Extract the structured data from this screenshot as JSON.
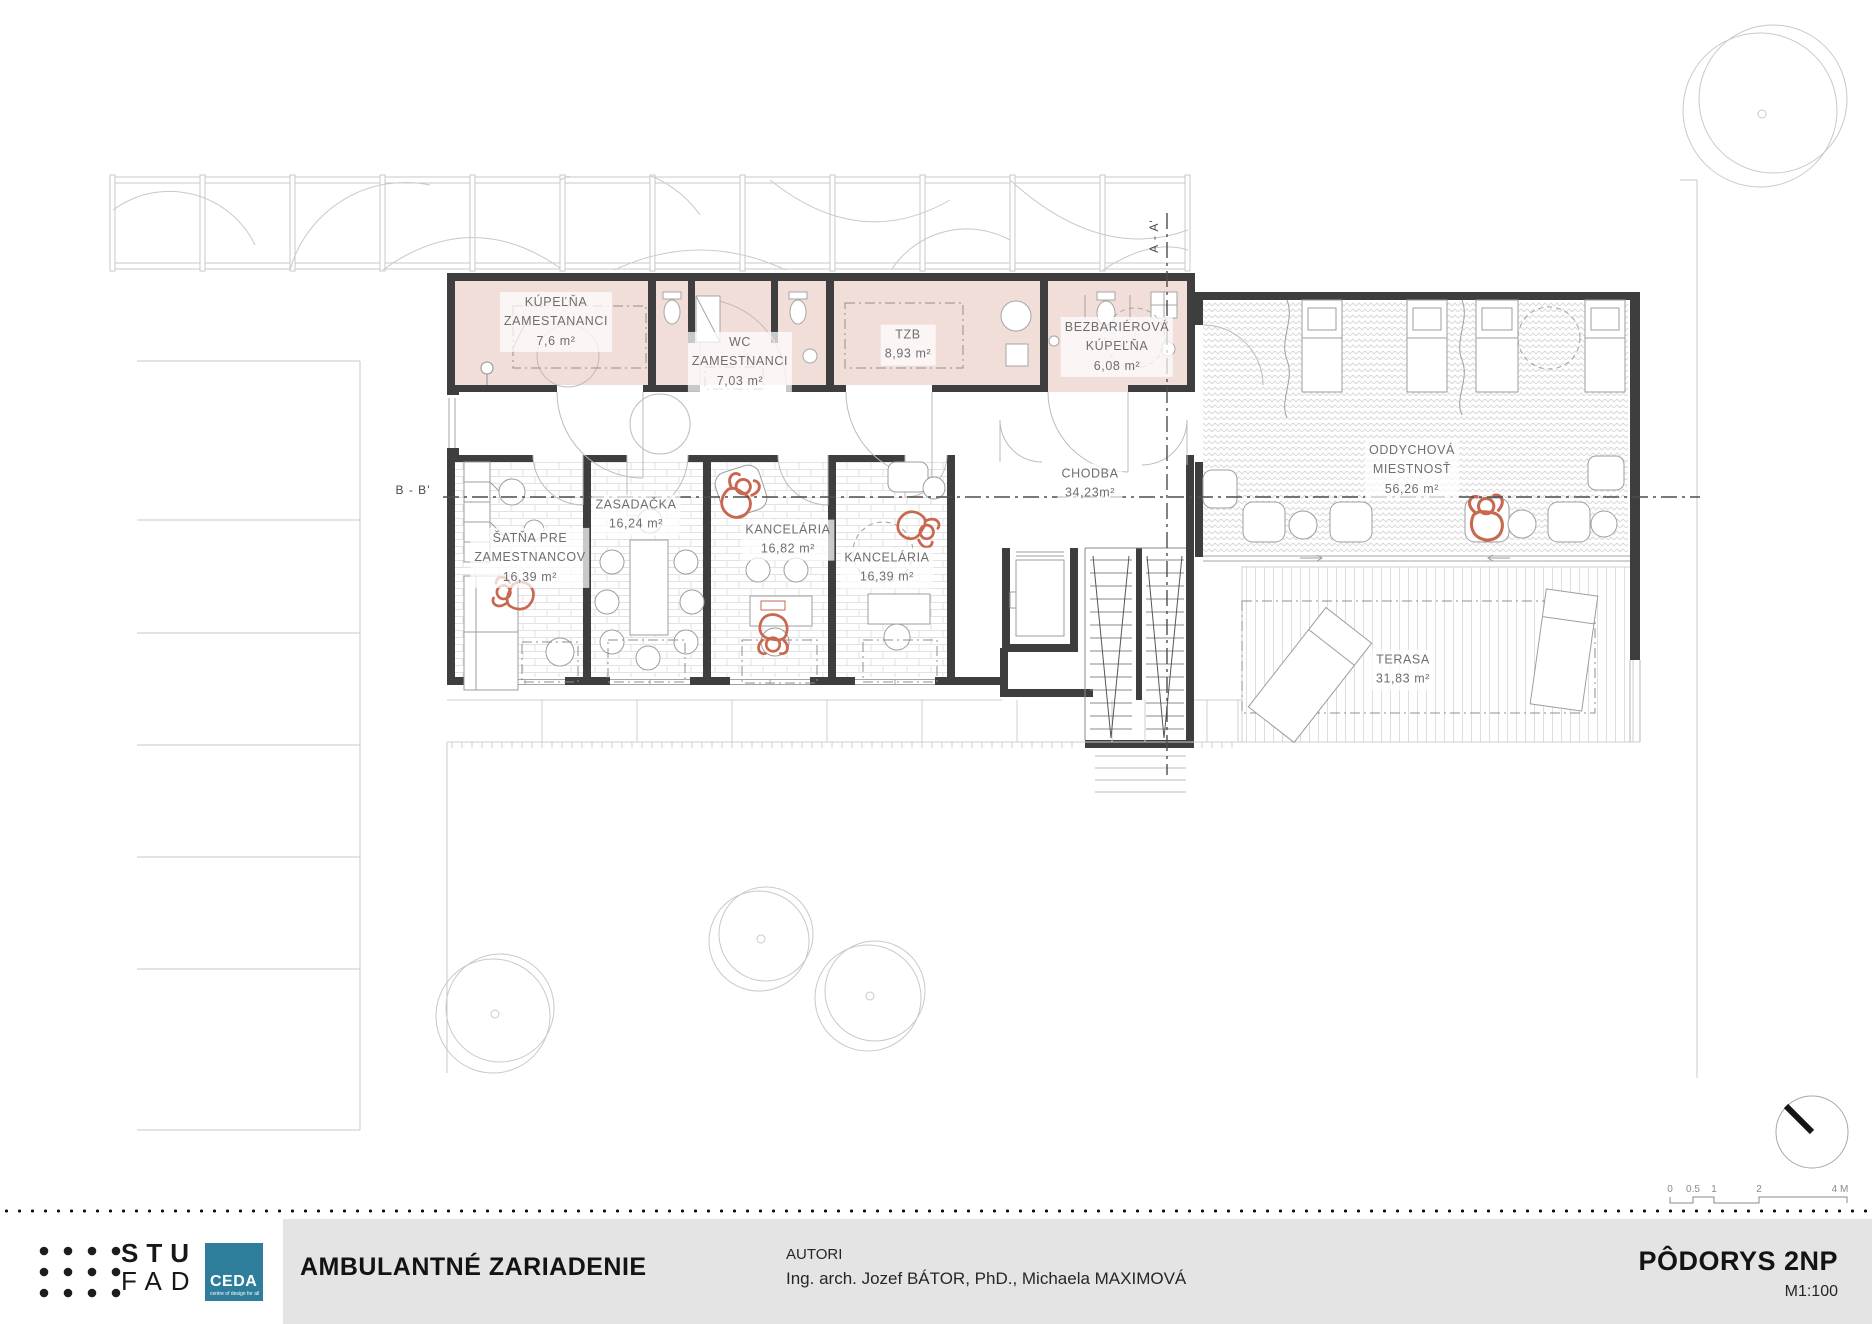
{
  "plan": {
    "rooms": [
      {
        "id": "kupelna-zamestnanci",
        "lines": [
          "KÚPEĽŇA",
          "ZAMESTANANCI",
          "7,6 m²"
        ]
      },
      {
        "id": "wc-zamestnanci",
        "lines": [
          "WC",
          "ZAMESTNANCI",
          "7,03 m²"
        ]
      },
      {
        "id": "tzb",
        "lines": [
          "TZB",
          "8,93 m²"
        ]
      },
      {
        "id": "bezbarierova-kupelna",
        "lines": [
          "BEZBARIÉROVÁ",
          "KÚPEĽŇA",
          "6,08 m²"
        ]
      },
      {
        "id": "oddychova-miestnost",
        "lines": [
          "ODDYCHOVÁ",
          "MIESTNOSŤ",
          "56,26 m²"
        ]
      },
      {
        "id": "chodba",
        "lines": [
          "CHODBA",
          "34,23m²"
        ]
      },
      {
        "id": "satna-pre-zamestnancov",
        "lines": [
          "ŠATŇA PRE",
          "ZAMESTNANCOV",
          "16,39 m²"
        ]
      },
      {
        "id": "zasadacka",
        "lines": [
          "ZASADAČKA",
          "16,24 m²"
        ]
      },
      {
        "id": "kancelaria-1",
        "lines": [
          "KANCELÁRIA",
          "16,82 m²"
        ]
      },
      {
        "id": "kancelaria-2",
        "lines": [
          "KANCELÁRIA",
          "16,39 m²"
        ]
      },
      {
        "id": "terasa",
        "lines": [
          "TERASA",
          "31,83 m²"
        ]
      }
    ],
    "sections": {
      "a_label": "A - A'",
      "b_label": "B - B'"
    },
    "scale_bar": {
      "ticks": [
        "0",
        "0.5",
        "1",
        "2",
        "4 M"
      ]
    }
  },
  "footer": {
    "logo_stu": "STU",
    "logo_fad": "FAD",
    "logo_ceda": "CEDA",
    "logo_ceda_sub": "centre of design for all",
    "project_title": "AMBULANTNÉ ZARIADENIE",
    "authors_label": "AUTORI",
    "authors": "Ing. arch. Jozef BÁTOR, PhD., Michaela MAXIMOVÁ",
    "drawing_title": "PÔDORYS 2NP",
    "drawing_scale": "M1:100"
  },
  "colors": {
    "room_fill": "#f1ded9",
    "wall": "#3f3e3e",
    "person_accent": "#c9674f",
    "ceda_blue": "#2d7d9b",
    "panel_grey": "#e4e4e4"
  }
}
